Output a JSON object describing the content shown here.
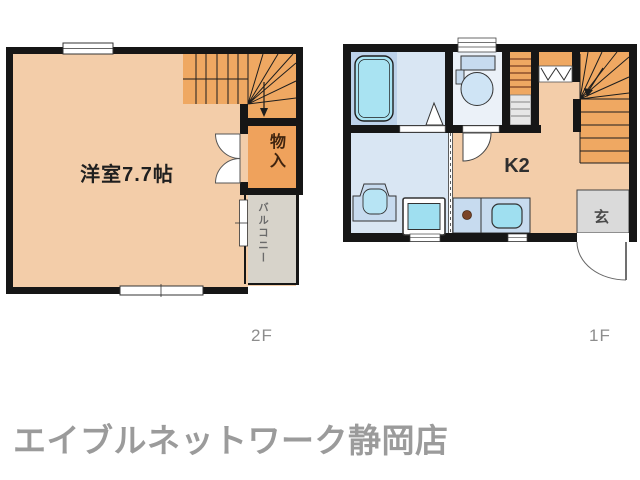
{
  "page": {
    "background": "#FFFFFF"
  },
  "plans": {
    "left": {
      "floor_label": "2F",
      "room_label": "洋室7.7帖",
      "storage_label": "物入",
      "balcony_label": "バルコニー"
    },
    "right": {
      "floor_label": "1F",
      "kitchen_label": "K2",
      "entrance_label": "玄"
    }
  },
  "footer": {
    "agency_name": "エイブルネットワーク静岡店"
  },
  "palette": {
    "wall": "#161616",
    "room_floor": "#F3CDA9",
    "stairs_orange": "#EFA862",
    "storage_orange": "#EFA25C",
    "balcony_gray": "#D7D3CA",
    "bath_floor": "#D9E6F3",
    "bath_zone": "#BDD2EA",
    "bathtub_cyan": "#A9E3F2",
    "toilet_floor": "#EBF1F8",
    "fixture_blue": "#C7DBEF",
    "sink_cyan": "#9FDFF0",
    "entrance_gray": "#DADADA",
    "burner_brown": "#7A4528"
  }
}
